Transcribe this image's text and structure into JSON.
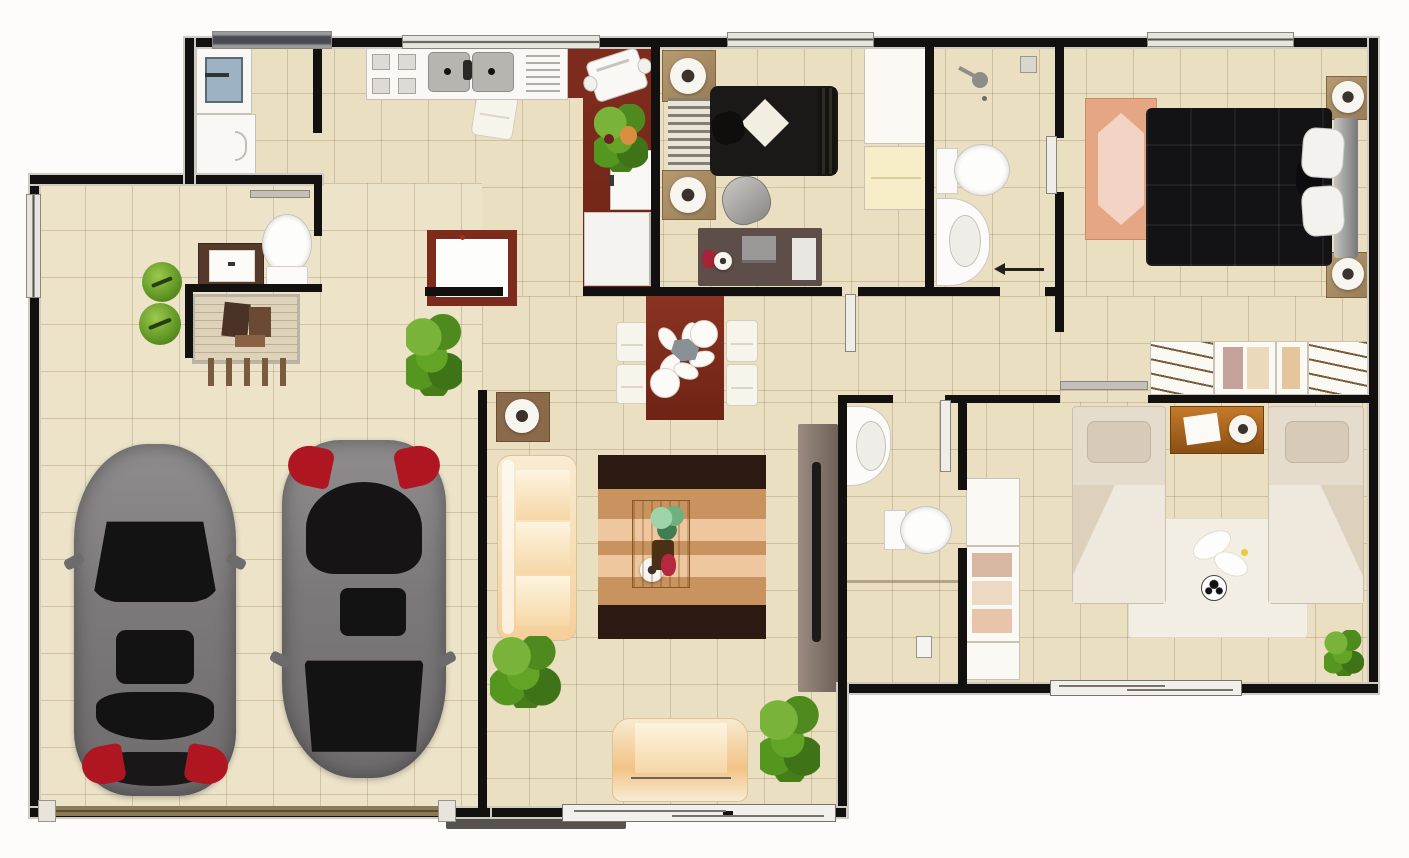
{
  "scene": {
    "type": "floor-plan",
    "description": "Top-down 3D rendered residential floor plan, fully furnished, with attached two-car garage",
    "background": "#fdfcfa"
  },
  "palette": {
    "floor_tile": "#eadfc1",
    "tile_grout": "#c7b894",
    "wall": "#121110",
    "maroon_wood": "#7c2b1c",
    "dark_bed": "#141316",
    "cream_upholstery": "#f5d9a8",
    "rug_tan": "#c8935f",
    "rug_pink": "#e5a683",
    "plant_green": "#5d9422",
    "car_gray": "#7c797a",
    "car_red_accent": "#b01622"
  },
  "rooms": {
    "garage": {
      "name": "Garage (two cars)",
      "items": [
        "car-front-facing-up",
        "car-front-facing-down",
        "garage-door",
        "topiary-plant",
        "topiary-plant",
        "console-bench"
      ]
    },
    "laundry": {
      "name": "Laundry / utility room",
      "items": [
        "washing-machine",
        "base-cabinet"
      ]
    },
    "kitchen": {
      "name": "Kitchen",
      "items": [
        "counter-with-stove-and-double-sink",
        "dish-rack",
        "dining-chair",
        "island-table",
        "coffee-maker",
        "fruit-and-plant-bowl",
        "wall-cabinet",
        "refrigerator"
      ]
    },
    "powder_room": {
      "name": "Powder room",
      "items": [
        "vanity-with-sink",
        "toilet"
      ]
    },
    "bedroom_top": {
      "name": "Bedroom (top center)",
      "items": [
        "double-bed-black",
        "striped-headboard",
        "nightstand-with-lamp",
        "nightstand-with-lamp",
        "armchair",
        "desk-with-laptop",
        "closet-with-hangers"
      ]
    },
    "bathroom_top": {
      "name": "Bathroom (top)",
      "items": [
        "shower-head",
        "toilet",
        "vanity-sink",
        "door-swing-arrow",
        "vent-switch"
      ]
    },
    "master_bedroom": {
      "name": "Master bedroom",
      "items": [
        "king-bed-black-quilted",
        "pillows",
        "headboard",
        "nightstand-with-lamp",
        "nightstand-with-lamp",
        "area-rug-pink",
        "wardrobe-with-hangers-and-clothes"
      ]
    },
    "dining": {
      "name": "Dining area",
      "items": [
        "maroon-table",
        "white-chair",
        "white-chair",
        "white-chair",
        "white-chair",
        "place-setting-fan",
        "round-plates"
      ]
    },
    "living": {
      "name": "Living room",
      "items": [
        "three-seat-sofa",
        "loveseat",
        "banded-rug",
        "coffee-table-with-plant",
        "tv-console",
        "flat-tv",
        "side-table-with-lamp",
        "floor-plant",
        "floor-plant"
      ]
    },
    "bathroom_bottom": {
      "name": "Bathroom (bottom)",
      "items": [
        "vanity-sink",
        "toilet",
        "light-switch"
      ]
    },
    "kids_bedroom": {
      "name": "Kids bedroom",
      "items": [
        "twin-bed",
        "twin-bed",
        "wood-nightstand-with-clock",
        "play-rug",
        "soccer-ball",
        "toys",
        "reach-in-closet",
        "potted-plant",
        "sliding-door"
      ]
    }
  },
  "counts": {
    "cars": 2,
    "beds": 4,
    "toilets": 3,
    "sofas": 2,
    "plants": 8,
    "closets": 4
  }
}
